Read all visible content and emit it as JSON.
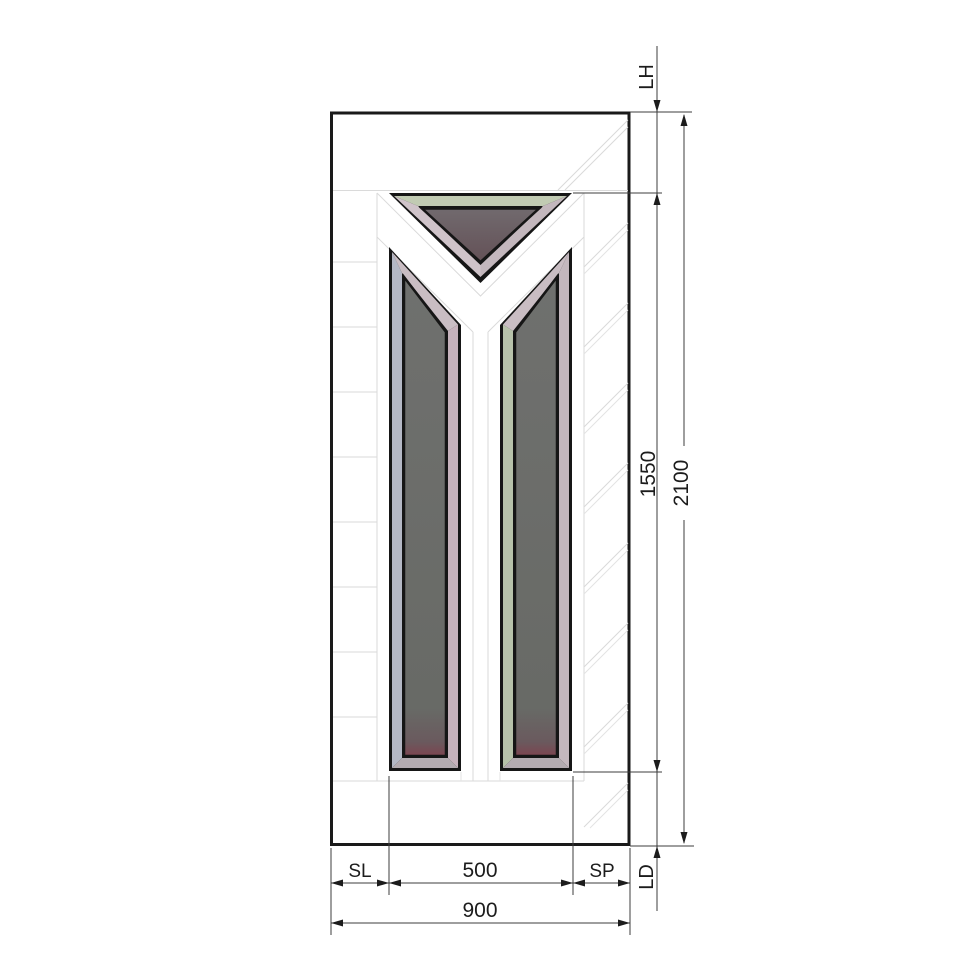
{
  "drawing": {
    "type": "door-glass-cutout-technical-drawing",
    "labels": {
      "lh": "LH",
      "glass_height": "1550",
      "door_height": "2100",
      "ld": "LD",
      "sl": "SL",
      "glass_width": "500",
      "sp": "SP",
      "door_width": "900"
    },
    "colors": {
      "background": "#ffffff",
      "door_border": "#1a1a1a",
      "frame": "#161616",
      "groove": "#dadada",
      "dimension": "#3c3c3c",
      "glass": "#6c6c6a",
      "glass_triangle": "#6e6669",
      "glass_bottom_edge": "#7c4450",
      "bevel_green": "#c1cbb3",
      "bevel_green_side": "#b7c2aa",
      "bevel_light_pink": "#cfc3c9",
      "bevel_pink": "#c6b2bc",
      "bevel_blue_gray": "#b4b8c5",
      "bevel_gray_pink": "#c3b7bd",
      "bevel_diag": "#c9bdc3",
      "bevel_bottom": "#b3abb0"
    }
  }
}
